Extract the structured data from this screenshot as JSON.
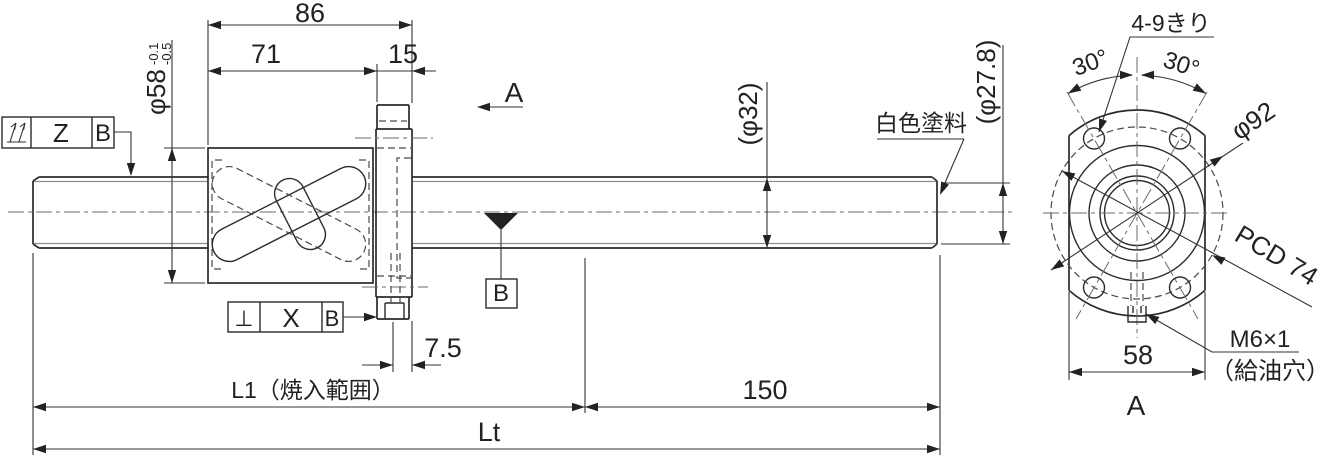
{
  "colors": {
    "line": "#2b2b2b",
    "thin_line": "#8f8f8f",
    "background": "#ffffff"
  },
  "side_view": {
    "dims": {
      "overall_nut": "86",
      "nut_body": "71",
      "flange_thickness": "15",
      "nut_od": "φ58",
      "nut_od_tol_upper": "-0.1",
      "nut_od_tol_lower": "-0.5",
      "screw_od": "(φ32)",
      "root_dia": "(φ27.8)",
      "oil_hole_offset": "7.5",
      "hardened_length": "L1（焼入範囲）",
      "end_length": "150",
      "total_length": "Lt"
    },
    "labels": {
      "white_paint": "白色塗料",
      "view_direction": "A",
      "datum": "B"
    },
    "fcf_runout": {
      "symbol": "total-runout",
      "tolerance": "Z",
      "datum": "B"
    },
    "fcf_perpendicularity": {
      "symbol": "⊥",
      "tolerance": "X",
      "datum": "B"
    }
  },
  "view_a": {
    "view_label": "A",
    "holes_note": "4-9きり",
    "angle_left": "30°",
    "angle_right": "30°",
    "flange_od": "φ92",
    "bolt_circle": "PCD 74",
    "width_across_flats": "58",
    "oil_hole_thread": "M6×1",
    "oil_hole_note": "（給油穴）"
  }
}
